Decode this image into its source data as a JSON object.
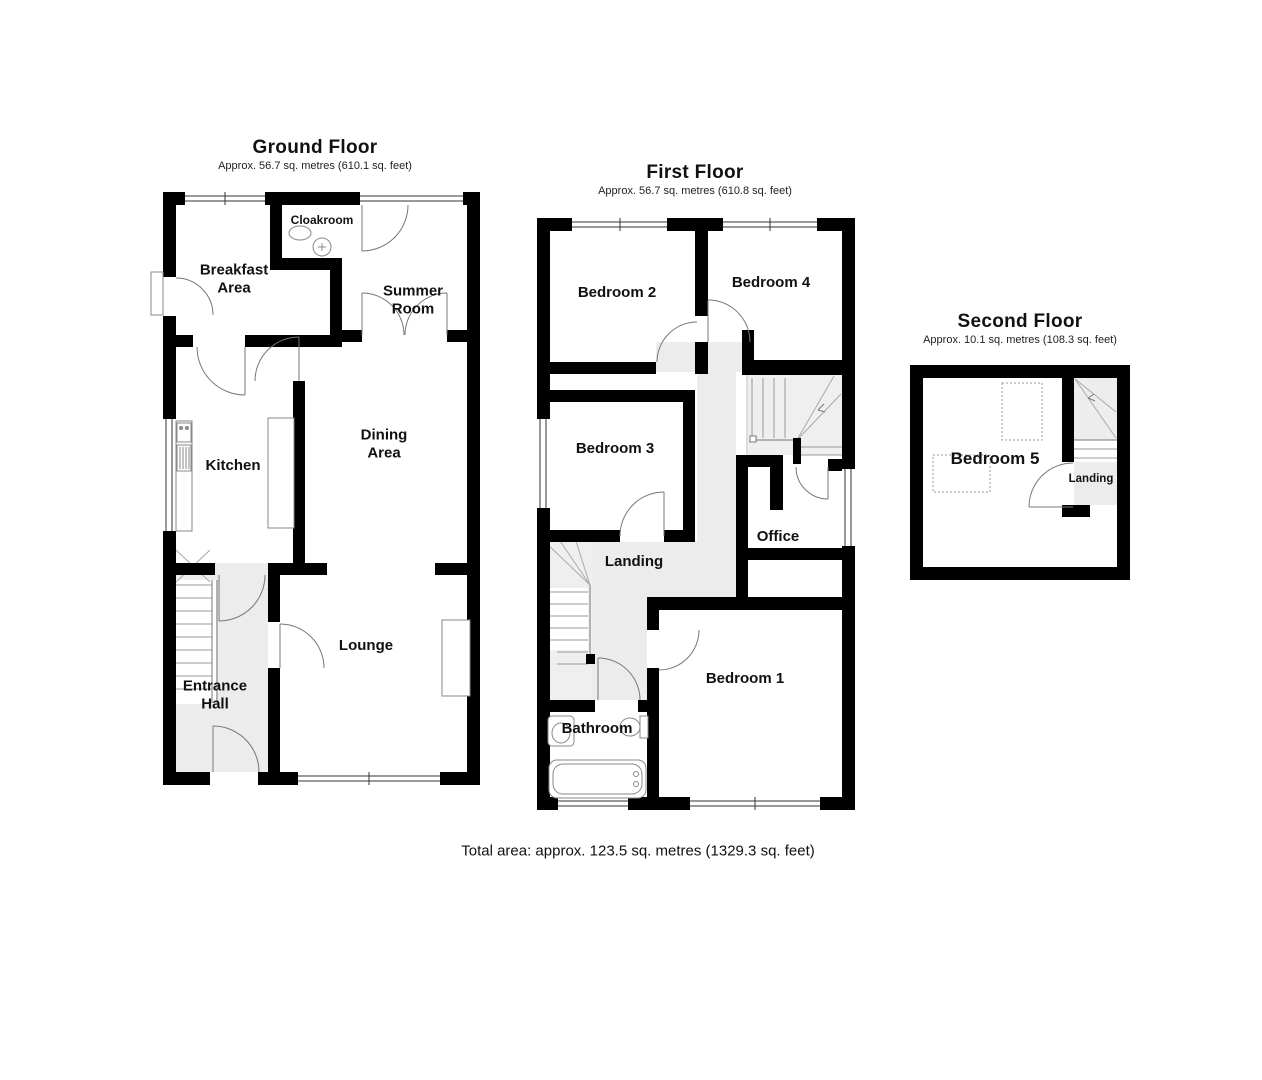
{
  "ground": {
    "title": "Ground Floor",
    "area": "Approx. 56.7 sq. metres (610.1 sq. feet)",
    "rooms": {
      "breakfast": "Breakfast\nArea",
      "cloakroom": "Cloakroom",
      "summer": "Summer\nRoom",
      "kitchen": "Kitchen",
      "dining": "Dining\nArea",
      "lounge": "Lounge",
      "entrance": "Entrance\nHall"
    }
  },
  "first": {
    "title": "First Floor",
    "area": "Approx. 56.7 sq. metres (610.8 sq. feet)",
    "rooms": {
      "bedroom2": "Bedroom 2",
      "bedroom4": "Bedroom 4",
      "bedroom3": "Bedroom 3",
      "landing": "Landing",
      "office": "Office",
      "bedroom1": "Bedroom 1",
      "bathroom": "Bathroom"
    }
  },
  "second": {
    "title": "Second Floor",
    "area": "Approx. 10.1 sq. metres (108.3 sq. feet)",
    "rooms": {
      "bedroom5": "Bedroom 5",
      "landing": "Landing"
    }
  },
  "total_area": "Total area: approx. 123.5 sq. metres (1329.3 sq. feet)",
  "colors": {
    "wall": "#000000",
    "hall_fill": "#ececec",
    "stair_fill": "#efefef",
    "line": "#666666"
  }
}
